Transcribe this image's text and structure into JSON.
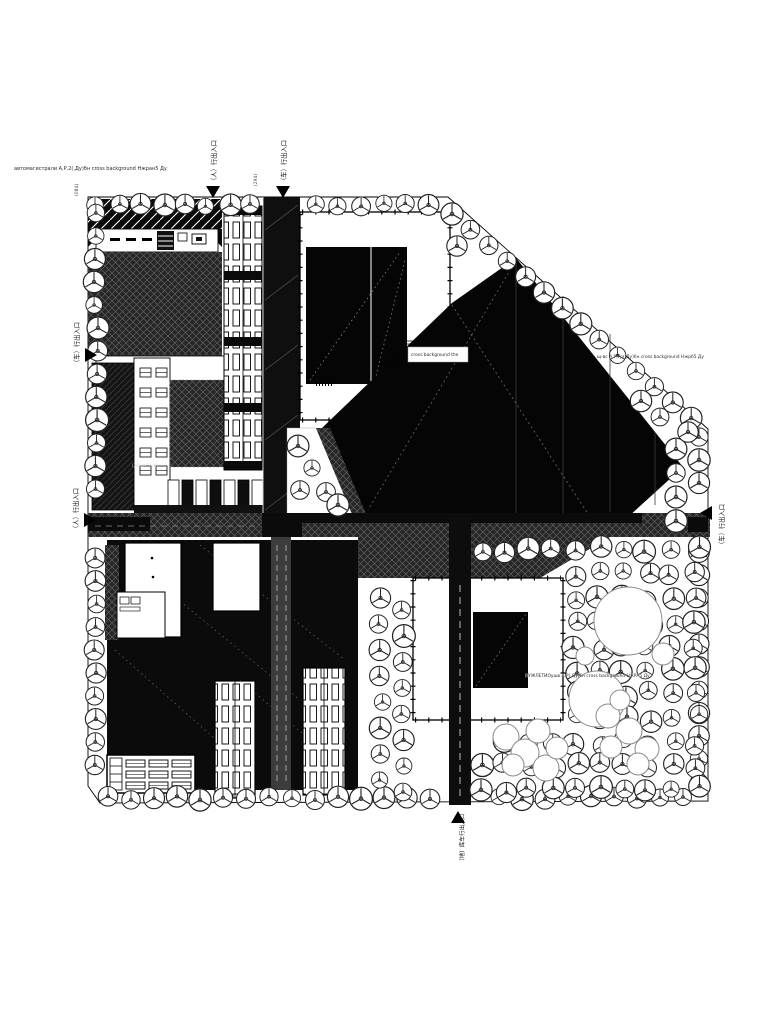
{
  "annotations": {
    "top_left": "автомагистрали А,Р,2(,Ду)бн cross background Нжран5 Ду",
    "roof_label": "cross background the",
    "right_mid": "щ-вс А,Р,Ур(,Ду)бн cross background Нжрб5 Ду",
    "bottom_mid": "ВУЖЛЕТИОушв А,Р(,Ду)бн cross background НжРА5 Ду",
    "parking_note": "(20 ме(1) (в)",
    "dim_a": "(084)",
    "dim_b": "(294)"
  },
  "entrances": {
    "top_pedestrian": "（人）行出入口",
    "top_vehicle": "（车）行出入口",
    "left_upper": "（车）行出入口",
    "left_lower": "（人）行出入口",
    "right_vehicle": "（车）行出入口",
    "bottom_garage": "（地）库车行出入口"
  },
  "colors": {
    "paper": "#ffffff",
    "ink": "#0b0b0b",
    "hatch_ground": "#262626",
    "hatch_line": "#5e5e5e",
    "tree_stroke": "#222222",
    "road_gray": "#3c3c3c"
  }
}
